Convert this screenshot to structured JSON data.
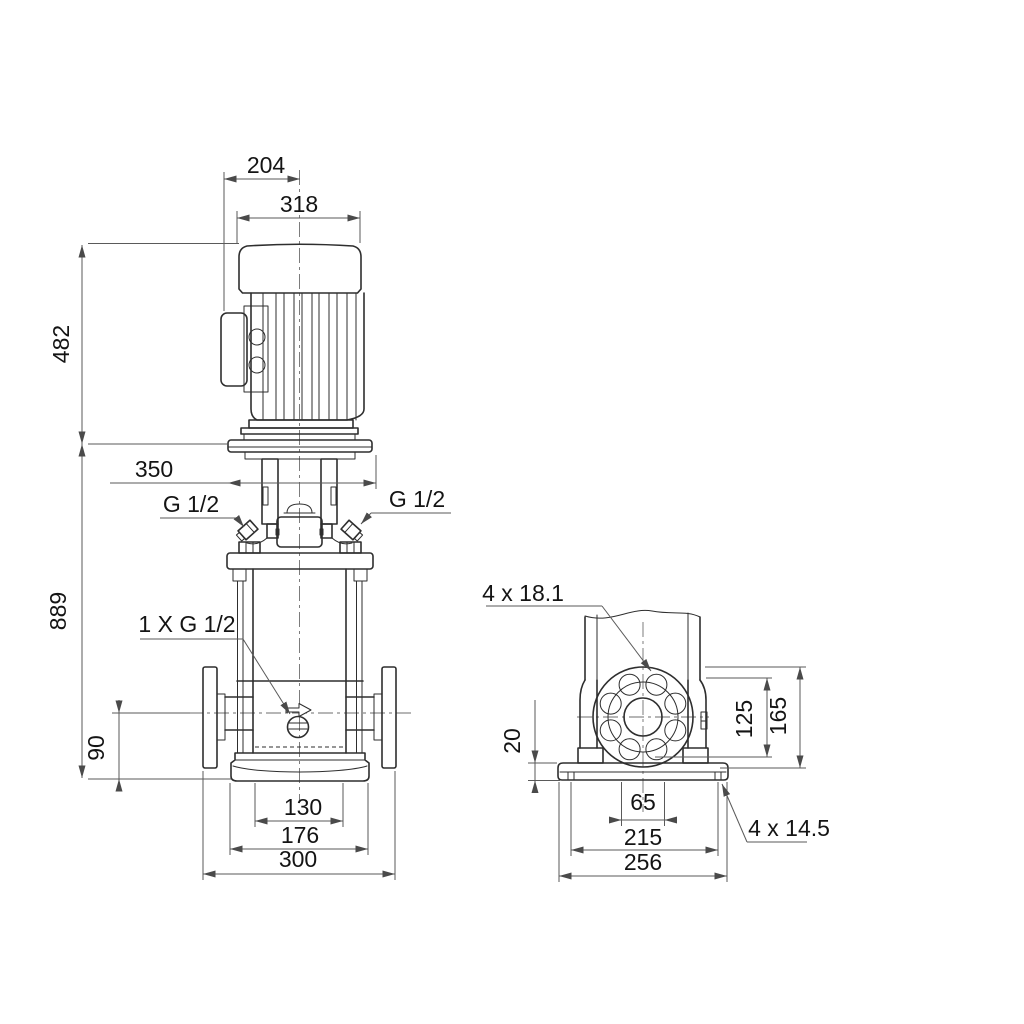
{
  "meta": {
    "title": "Pump dimensional drawing",
    "background": "#ffffff",
    "object_line_color": "#2e2e2e",
    "dimension_line_color": "#5a5a5a",
    "text_color": "#141414"
  },
  "front_view": {
    "dims": {
      "motor_depth": "204",
      "motor_width": "318",
      "motor_height": "482",
      "stool_span": "350",
      "total_height": "889",
      "port_height": "90",
      "base_holes_span": "130",
      "base_width": "176",
      "port_span": "300",
      "plug_left": "G 1/2",
      "plug_right": "G 1/2",
      "drain_plug": "1 X G 1/2"
    }
  },
  "side_view": {
    "dims": {
      "flange_holes": "4 x 18.1",
      "flange_bolt_span": "125",
      "flange_height": "165",
      "baseplate_thickness": "20",
      "base_inner_span": "65",
      "base_outer_span": "215",
      "baseplate_width": "256",
      "baseplate_holes": "4 x 14.5"
    }
  }
}
